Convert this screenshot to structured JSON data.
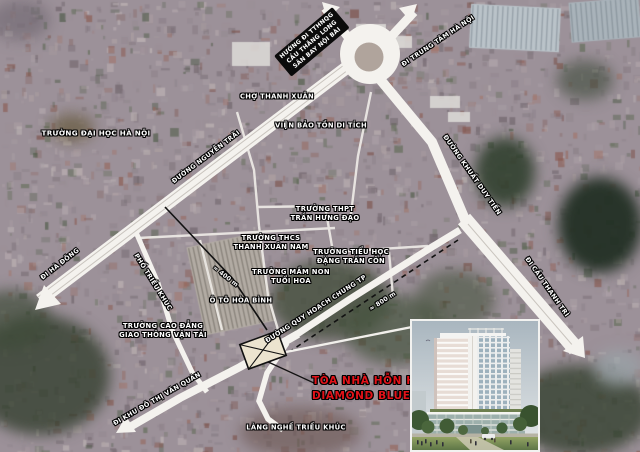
{
  "map": {
    "colors": {
      "site_label_red": "#e31219",
      "road_white": "#f4f2ee",
      "label_box_black": "#0b0b0b",
      "satellite_base": "#9c9199"
    },
    "labels": [
      {
        "id": "truong-dai-hoc-ha-noi",
        "lines": [
          "TRƯỜNG ĐẠI HỌC HÀ NỘI"
        ],
        "x": 96,
        "y": 133,
        "rot": 0,
        "type": "big"
      },
      {
        "id": "cho-thanh-xuan",
        "lines": [
          "CHỢ THANH XUÂN"
        ],
        "x": 277,
        "y": 97,
        "rot": 0,
        "type": ""
      },
      {
        "id": "huong-di-tthnqg",
        "lines": [
          "HƯỚNG ĐI TTHNQG",
          "CẦU THĂNG LONG",
          "SÂN BAY NỘI BÀI"
        ],
        "x": 312,
        "y": 42,
        "rot": -40,
        "type": "boxed"
      },
      {
        "id": "di-trung-tam-ha-noi",
        "lines": [
          "ĐI TRUNG TÂM HÀ NỘI"
        ],
        "x": 438,
        "y": 41,
        "rot": -34,
        "type": "road"
      },
      {
        "id": "vien-bao-ton-di-tich",
        "lines": [
          "VIỆN BẢO TỒN DI TÍCH"
        ],
        "x": 321,
        "y": 126,
        "rot": 0,
        "type": ""
      },
      {
        "id": "duong-nguyen-trai",
        "lines": [
          "ĐƯỜNG NGUYỄN TRÃI"
        ],
        "x": 206,
        "y": 157,
        "rot": -37,
        "type": "road"
      },
      {
        "id": "duong-khuat-duy-tien",
        "lines": [
          "ĐƯỜNG KHUẤT DUY TIẾN"
        ],
        "x": 472,
        "y": 175,
        "rot": 55,
        "type": "road"
      },
      {
        "id": "truong-thpt-tran-hung-dao",
        "lines": [
          "TRƯỜNG THPT",
          "TRẦN HƯNG ĐẠO"
        ],
        "x": 325,
        "y": 214,
        "rot": 0,
        "type": ""
      },
      {
        "id": "truong-thcs-thanh-xuan-nam",
        "lines": [
          "TRƯỜNG THCS",
          "THANH XUÂN NAM"
        ],
        "x": 271,
        "y": 243,
        "rot": 0,
        "type": ""
      },
      {
        "id": "truong-tieu-hoc-dang-tran-con",
        "lines": [
          "TRƯỜNG TIỂU HỌC",
          "ĐẶNG TRẦN CÔN"
        ],
        "x": 351,
        "y": 257,
        "rot": 0,
        "type": ""
      },
      {
        "id": "truong-mam-non-tuoi-hoa",
        "lines": [
          "TRƯỜNG MẦM NON",
          "TUỔI HOA"
        ],
        "x": 291,
        "y": 277,
        "rot": 0,
        "type": ""
      },
      {
        "id": "o-to-hoa-binh",
        "lines": [
          "Ô TÔ HÒA BÌNH"
        ],
        "x": 241,
        "y": 301,
        "rot": 0,
        "type": ""
      },
      {
        "id": "truong-cao-dang-gtvt",
        "lines": [
          "TRƯỜNG CAO ĐẲNG",
          "GIAO THÔNG VẬN TẢI"
        ],
        "x": 163,
        "y": 331,
        "rot": 0,
        "type": ""
      },
      {
        "id": "di-ha-dong",
        "lines": [
          "ĐI HÀ ĐÔNG"
        ],
        "x": 60,
        "y": 264,
        "rot": -38,
        "type": "road"
      },
      {
        "id": "pho-trieu-khuc",
        "lines": [
          "PHỐ TRIỀU KHÚC"
        ],
        "x": 153,
        "y": 282,
        "rot": 58,
        "type": "road"
      },
      {
        "id": "duong-quy-hoach-chung-tp",
        "lines": [
          "ĐƯỜNG QUY HOẠCH CHUNG TP"
        ],
        "x": 316,
        "y": 309,
        "rot": -33,
        "type": "road"
      },
      {
        "id": "khoang-cach-800m",
        "lines": [
          "≈ 800 m"
        ],
        "x": 383,
        "y": 302,
        "rot": -33,
        "type": "dist"
      },
      {
        "id": "khoang-cach-400m",
        "lines": [
          "≈ 400 m"
        ],
        "x": 225,
        "y": 277,
        "rot": 38,
        "type": "dist"
      },
      {
        "id": "di-cau-thanh-tri",
        "lines": [
          "ĐI CẦU THANH TRÌ"
        ],
        "x": 547,
        "y": 287,
        "rot": 55,
        "type": "road"
      },
      {
        "id": "di-khu-do-thi-van-quan",
        "lines": [
          "ĐI KHU ĐÔ THỊ VĂN QUÁN"
        ],
        "x": 157,
        "y": 399,
        "rot": -30,
        "type": "road"
      },
      {
        "id": "lang-nghe-trieu-khuc",
        "lines": [
          "LÀNG NGHỀ TRIỀU KHÚC"
        ],
        "x": 296,
        "y": 428,
        "rot": 0,
        "type": ""
      }
    ],
    "site_label": {
      "lines": [
        "TÒA NHÀ HỖN HỢP",
        "DIAMOND BLUE"
      ]
    },
    "inset_image": "diamond-blue-building-render"
  }
}
